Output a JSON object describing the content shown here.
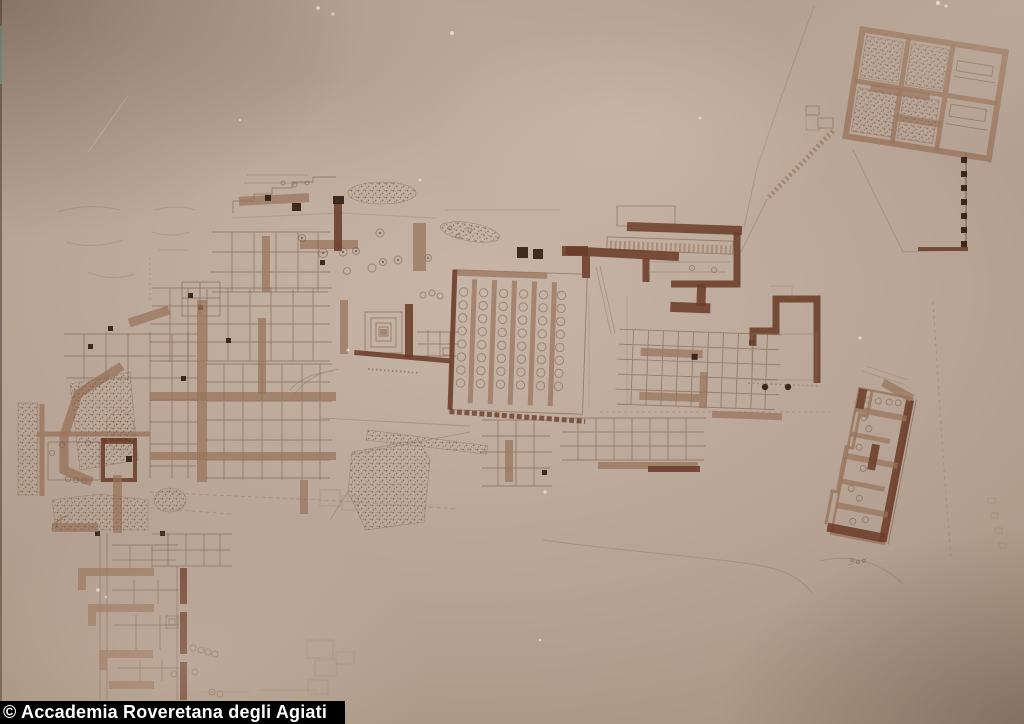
{
  "caption": {
    "text": "© Accademia Roveretana degli Agiati"
  },
  "theme": {
    "css_vars": "--paper-mid:#b3a094;--paper-light:#c7b5a6;--paper-dark:#8d7869;--ink:#7a5c48;--ink-faint:#927a66;--wall-mid:#97735a;--wall-dark:#6b3e2a;--pillar:#2e1c11;--photo-teal:#8fae9f;--bar-bg:#000000;--bar-text:#ffffff",
    "colors": {
      "paper_mid": "#b3a094",
      "paper_light": "#c7b5a6",
      "paper_dark": "#8d7869",
      "drawing_ink": "#7a5c48",
      "wall_medium": "#97735a",
      "wall_dark": "#6b3e2a",
      "pillar_black": "#2e1c11",
      "photo_edge_teal": "#8fae9f",
      "caption_bar_bg": "#000000",
      "caption_text": "#ffffff"
    }
  }
}
